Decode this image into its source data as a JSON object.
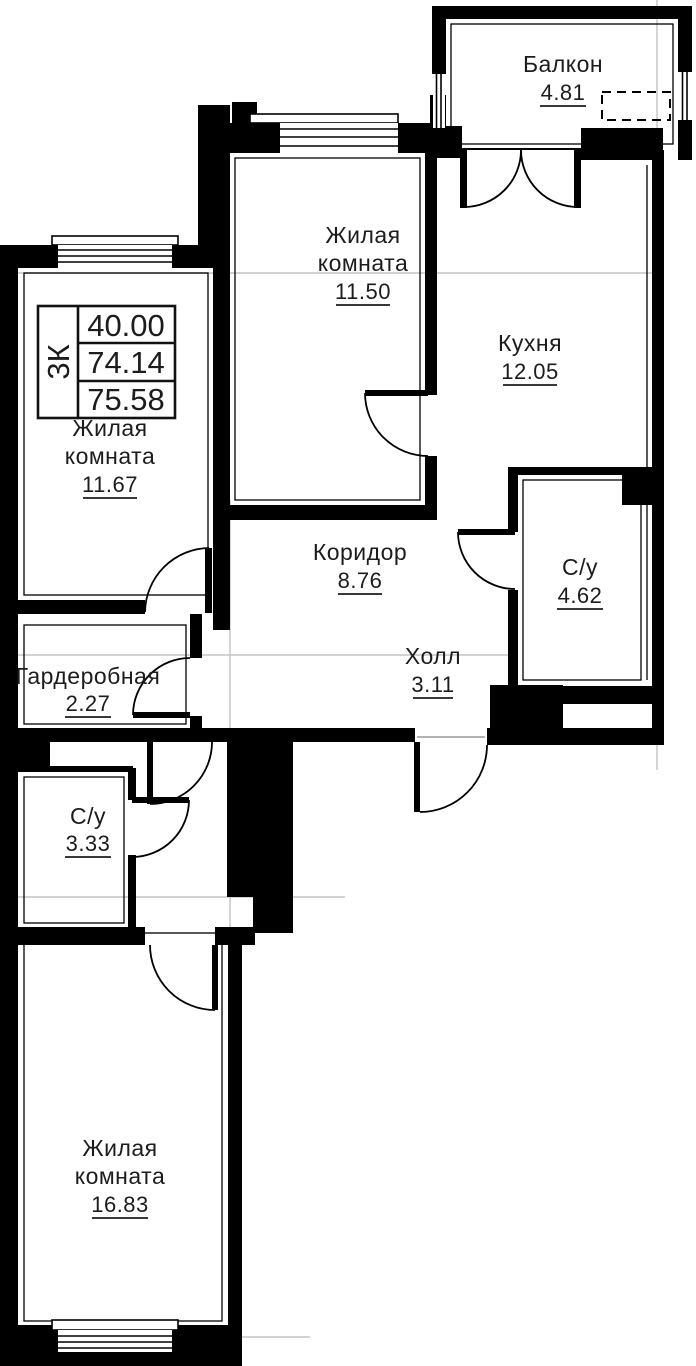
{
  "plan_type": "apartment-floor-plan",
  "summary_table": {
    "type": "3К",
    "values": [
      "40.00",
      "74.14",
      "75.58"
    ]
  },
  "rooms": [
    {
      "name": "Балкон",
      "area": "4.81"
    },
    {
      "name": "Жилая",
      "name2": "комната",
      "area": "11.50"
    },
    {
      "name": "Кухня",
      "area": "12.05"
    },
    {
      "name": "Жилая",
      "name2": "комната",
      "area": "11.67"
    },
    {
      "name": "Коридор",
      "area": "8.76"
    },
    {
      "name": "С/у",
      "area": "4.62"
    },
    {
      "name": "Холл",
      "area": "3.11"
    },
    {
      "name": "Гардеробная",
      "area": "2.27"
    },
    {
      "name": "С/у",
      "area": "3.33"
    },
    {
      "name": "Жилая",
      "name2": "комната",
      "area": "16.83"
    }
  ],
  "colors": {
    "wall": "#000000",
    "text": "#1c1c1c",
    "axis_line": "#c3c3c3",
    "background": "#ffffff"
  }
}
